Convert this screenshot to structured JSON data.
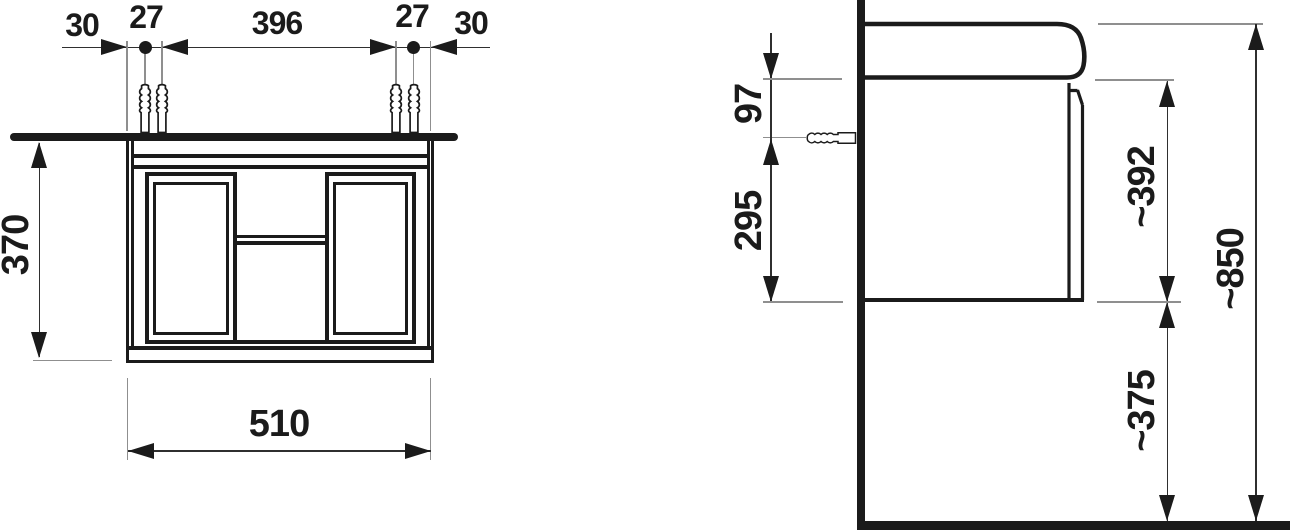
{
  "front_view": {
    "offset_left": "30",
    "screw_spacing_left": "27",
    "screw_span": "396",
    "screw_spacing_right": "27",
    "offset_right": "30",
    "cabinet_height": "370",
    "cabinet_width": "510"
  },
  "side_view": {
    "basin_to_anchor": "97",
    "anchor_to_cabinet_bottom": "295",
    "cabinet_with_basin_height": "~392",
    "total_height": "~850",
    "floor_clearance": "~375"
  },
  "colors": {
    "line": "#1b1b1b",
    "dim_line": "#2f2f2f",
    "ext_line": "#8f8f8f",
    "background": "#ffffff"
  }
}
